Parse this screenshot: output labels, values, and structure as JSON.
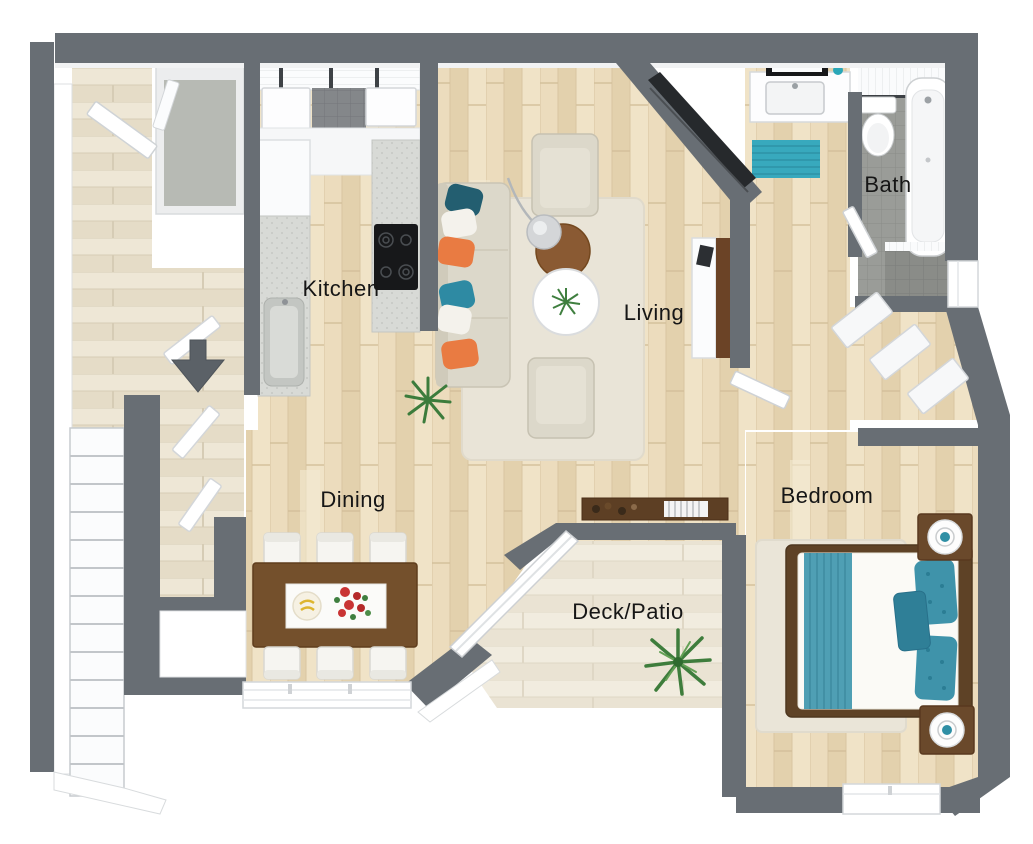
{
  "meta": {
    "type": "3d-floor-plan-rendering",
    "view": "top-down"
  },
  "rooms": [
    {
      "id": "kitchen",
      "label": "Kitchen"
    },
    {
      "id": "living",
      "label": "Living"
    },
    {
      "id": "bath",
      "label": "Bath"
    },
    {
      "id": "bedroom",
      "label": "Bedroom"
    },
    {
      "id": "dining",
      "label": "Dining"
    },
    {
      "id": "deck_patio",
      "label": "Deck/Patio"
    }
  ],
  "colors": {
    "wall": "#686e74",
    "floor_wood": "#e9d9ba",
    "floor_whitewash": "#ebe3d1",
    "tile_gray": "#9a9c98",
    "accent_teal": "#38a9bd",
    "accent_teal_dark": "#235e70",
    "accent_orange": "#e97b42",
    "furniture_brown": "#74502c",
    "upholstery_cream": "#dcd8ca"
  },
  "annotations": {
    "entry_arrow": "entry-direction-indicator"
  }
}
